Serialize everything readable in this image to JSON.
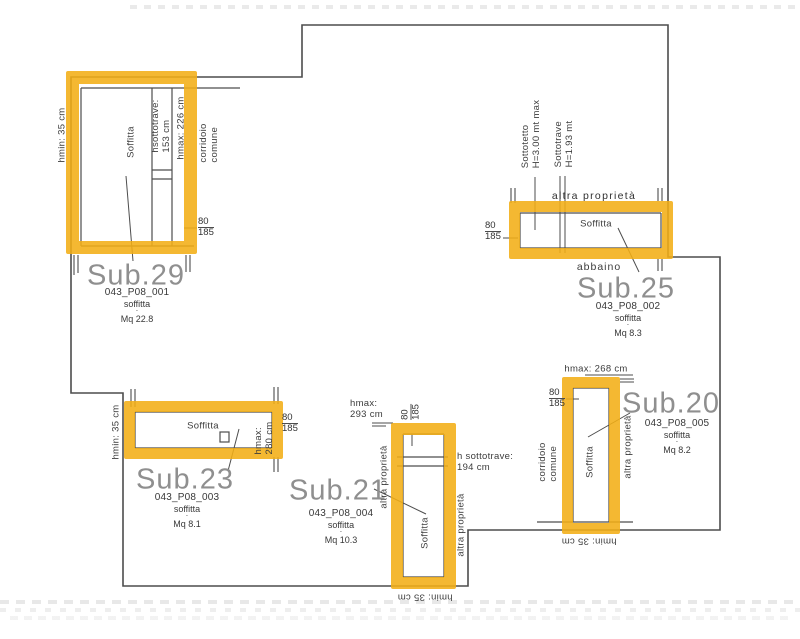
{
  "highlight_color": "#f2ae1c",
  "line_color": "#4d4d4d",
  "rooms": {
    "sub29": {
      "title": "Sub.29",
      "code": "043_P08_001",
      "kind": "soffitta",
      "area": "Mq 22.8",
      "interior": "Soffitta",
      "hmin": "hmin:  35  cm",
      "hmax": "hmax:  226  cm",
      "hsottotrave": "hsottotrave:\n153  cm",
      "corridor": "corridoio\ncomune",
      "door": {
        "top": "80",
        "bottom": "185"
      }
    },
    "sub25": {
      "title": "Sub.25",
      "code": "043_P08_002",
      "kind": "soffitta",
      "area": "Mq 8.3",
      "interior": "Soffitta",
      "neighbor": "altra  proprietà",
      "dormer": "abbaino",
      "sottotetto": "Sottotetto\nH=3.00  mt  max",
      "sottotrave": "Sottotrave\nH=1.93  mt",
      "door": {
        "top": "80",
        "bottom": "185"
      }
    },
    "sub23": {
      "title": "Sub.23",
      "code": "043_P08_003",
      "kind": "soffitta",
      "area": "Mq 8.1",
      "interior": "Soffitta",
      "hmin": "hmin:  35  cm",
      "hmax": "hmax:\n280  cm",
      "door": {
        "top": "80",
        "bottom": "185"
      }
    },
    "sub21": {
      "title": "Sub.21",
      "code": "043_P08_004",
      "kind": "soffitta",
      "area": "Mq 10.3",
      "interior": "Soffitta",
      "hmax": "hmax:\n293  cm",
      "hmin": "hmin:  35  cm",
      "sottotrave": "h  sottotrave:\n194  cm",
      "neighbor_left": "altra proprietà",
      "neighbor_right": "altra  proprietà",
      "door": {
        "top": "80",
        "bottom": "185"
      }
    },
    "sub20": {
      "title": "Sub.20",
      "code": "043_P08_005",
      "kind": "soffitta",
      "area": "Mq 8.2",
      "interior": "Soffitta",
      "hmax": "hmax:  268  cm",
      "hmin": "hmin:  35  cm",
      "corridor": "corridoio\ncomune",
      "neighbor": "altra  proprietà",
      "door": {
        "top": "80",
        "bottom": "185"
      }
    }
  }
}
